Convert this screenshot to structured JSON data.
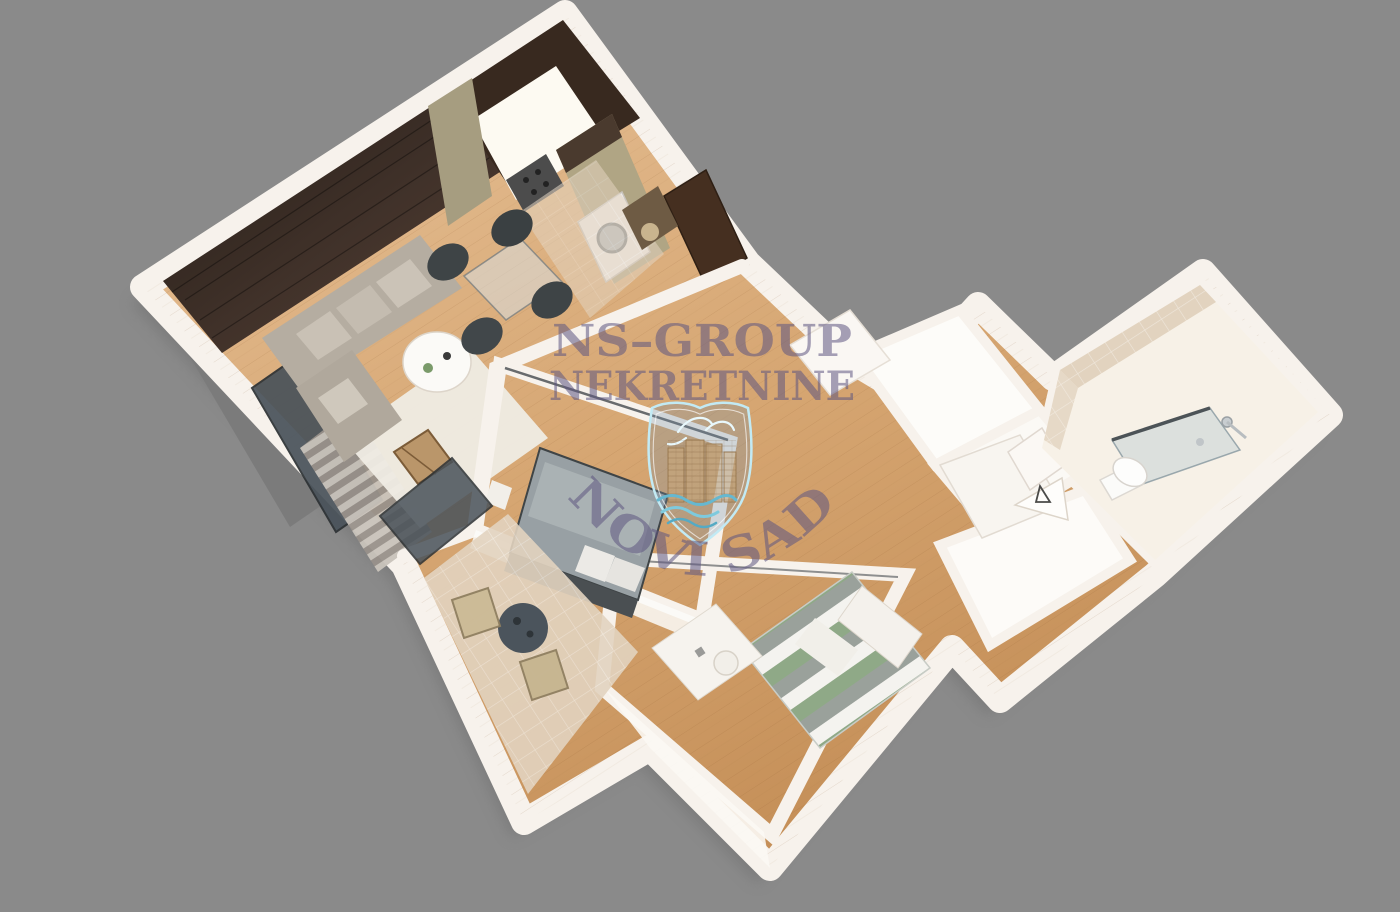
{
  "scene": {
    "type": "3d-apartment-floorplan-render",
    "background_color": "#8a8a8a"
  },
  "watermark": {
    "line1": "NS–GROUP",
    "line2": "NEKRETNINE",
    "city_arc": "NOVI SAD",
    "text_color": "#5e5681",
    "logo": {
      "type": "shield-crest",
      "outline_color": "#c2eaf4",
      "elements": [
        "dove-with-branch-icon",
        "city-buildings-icon",
        "river-waves-icon"
      ]
    }
  },
  "floorplan": {
    "wall_color": "#f7f2ec",
    "wood_floor_color": "#d2a271",
    "accent_wall_color": "#38291f",
    "kitchen_cabinet_color": "#aba179",
    "tile_color": "#e2d3bf",
    "rooms": [
      {
        "name": "living-room",
        "furniture": [
          "corner-sofa",
          "round-coffee-table",
          "white-rug",
          "curtains",
          "window",
          "wooden-side-chair"
        ]
      },
      {
        "name": "kitchen-dining",
        "furniture": [
          "kitchen-cabinets",
          "counter",
          "stove",
          "washing-machine",
          "glass-dining-table",
          "four-chairs"
        ]
      },
      {
        "name": "entry-hall",
        "furniture": [
          "entry-door",
          "shoe-bench"
        ]
      },
      {
        "name": "master-bedroom",
        "furniture": [
          "double-bed",
          "pillows",
          "bench"
        ]
      },
      {
        "name": "kids-bedroom",
        "furniture": [
          "single-bed-chevron-duvet",
          "desk",
          "stool"
        ]
      },
      {
        "name": "hallway",
        "furniture": [
          "white-wardrobe",
          "cabinet-open-door",
          "sailboat-decor"
        ]
      },
      {
        "name": "bathroom",
        "furniture": [
          "toilet",
          "walk-in-shower-glass",
          "chrome-fixtures"
        ]
      },
      {
        "name": "balcony",
        "furniture": [
          "bistro-table",
          "wicker-chair",
          "wicker-chair"
        ]
      }
    ]
  }
}
